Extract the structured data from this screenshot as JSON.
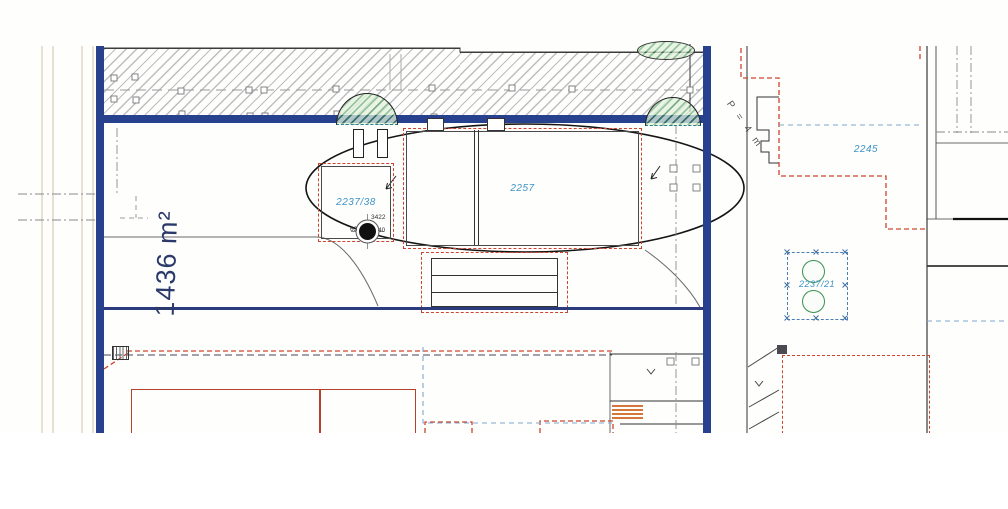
{
  "plan": {
    "area_annotation": "1436 m²",
    "distance_note": "P = 4 m",
    "parcels": {
      "p2237_38": "2237/38",
      "p2257": "2257",
      "p2245": "2245",
      "p2237_21": "2237/21"
    },
    "survey_point": {
      "number": "3422",
      "left_offset": "63",
      "right_offset": "40"
    },
    "icons": {
      "trees": "tree-canopy-icon",
      "survey_point": "survey-point-icon",
      "direction_arrows": "direction-arrow-icon"
    },
    "colors": {
      "boundary_blue": "#27418f",
      "parcel_label_blue": "#3e93c6",
      "red_dashed": "#cc4430",
      "building_red": "#b5432c",
      "tree_green": "#3a9150",
      "hatch_gray": "#96969c",
      "annotation_ink": "#2b3a6a",
      "stairs_orange": "#d4763b"
    }
  }
}
